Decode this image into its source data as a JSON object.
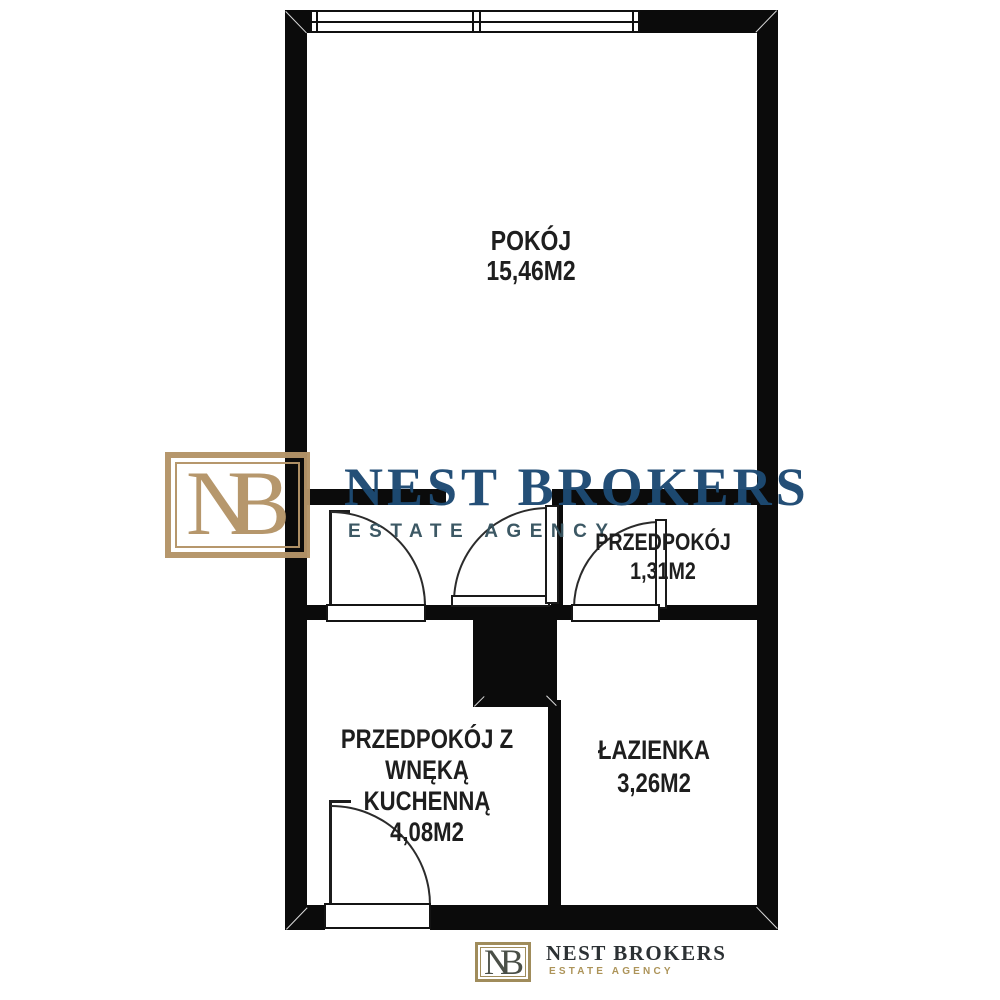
{
  "plan": {
    "rooms": [
      {
        "id": "pokoj",
        "name": "POKÓJ",
        "area": "15,46M2"
      },
      {
        "id": "przedpokoj",
        "name": "PRZEDPOKÓJ",
        "area": "1,31M2"
      },
      {
        "id": "przedpokoj-kuchnia",
        "name_line1": "PRZEDPOKÓJ Z WNĘKĄ",
        "name_line2": "KUCHENNĄ",
        "area": "4,08M2"
      },
      {
        "id": "lazienka",
        "name": "ŁAZIENKA",
        "area": "3,26M2"
      }
    ],
    "features": [
      "window-top",
      "entrance-door-bottom",
      "shaft-black-square",
      "interior-doors"
    ]
  },
  "brand": {
    "initial_n": "N",
    "initial_b": "B",
    "name": "NEST BROKERS",
    "tagline": "ESTATE AGENCY",
    "colors": {
      "gold": "#b49468",
      "navy": "#1d4a73",
      "tagline_teal": "#36535f"
    }
  },
  "footer_brand": {
    "initial_n": "N",
    "initial_b": "B",
    "name": "NEST BROKERS",
    "tagline": "ESTATE AGENCY",
    "colors": {
      "gold": "#a08c5b",
      "dark": "#2c3134"
    }
  }
}
